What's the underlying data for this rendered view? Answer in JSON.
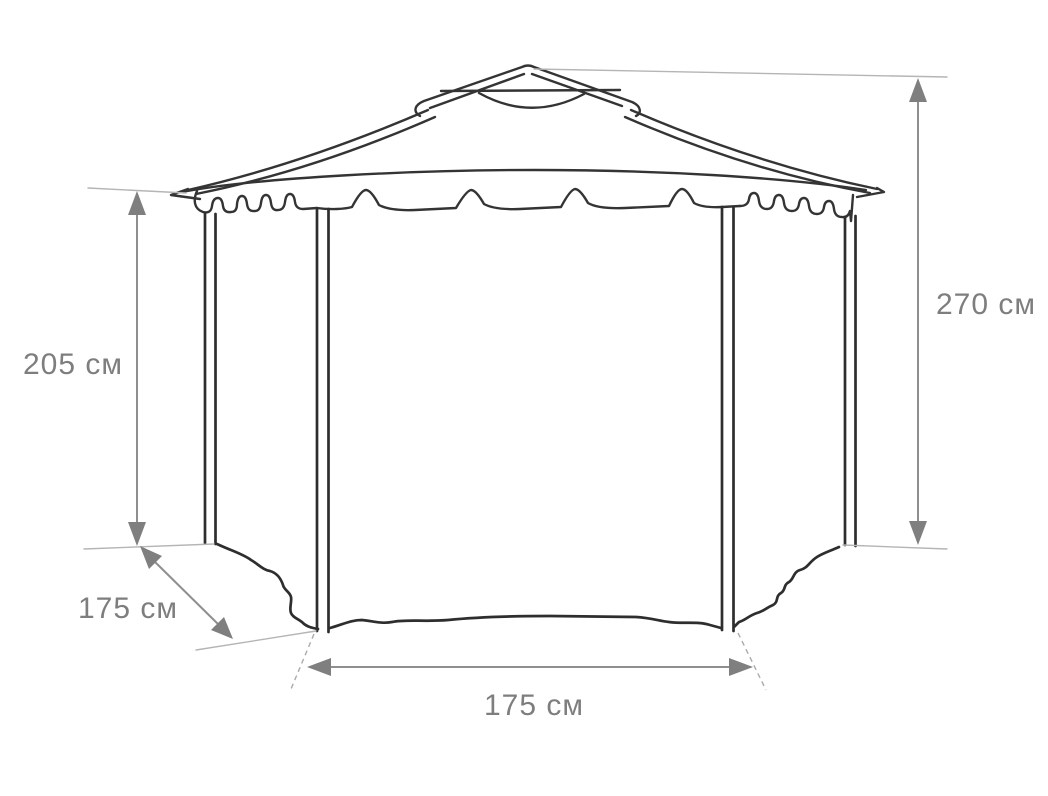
{
  "figure": {
    "type": "technical-dimension-drawing",
    "subject": "hexagonal garden gazebo (pavilion) with fabric roof, valance and side curtains",
    "background_color": "#ffffff",
    "structure_line_color": "#343434",
    "dimension_line_color": "#8f8f8f",
    "extension_line_color": "#b5b5b5",
    "label_color": "#7e7e7e",
    "units": "см",
    "dimensions": {
      "left_post_height": {
        "label": "205 см",
        "value": 205,
        "orientation": "vertical",
        "measures": "height from ground to roof eave (left post)"
      },
      "total_height": {
        "label": "270 см",
        "value": 270,
        "orientation": "vertical",
        "measures": "total height from ground to roof peak (right side)"
      },
      "side_panel_depth": {
        "label": "175 см",
        "value": 175,
        "orientation": "diagonal",
        "measures": "depth of angled side panel (lower left)"
      },
      "front_width": {
        "label": "175 см",
        "value": 175,
        "orientation": "horizontal",
        "measures": "front panel width between inner posts (bottom)"
      }
    },
    "parts": [
      "roof-cap",
      "roof-vent-dome",
      "main-roof",
      "eave-valance",
      "outer-posts",
      "inner-posts",
      "fabric-walls"
    ]
  }
}
